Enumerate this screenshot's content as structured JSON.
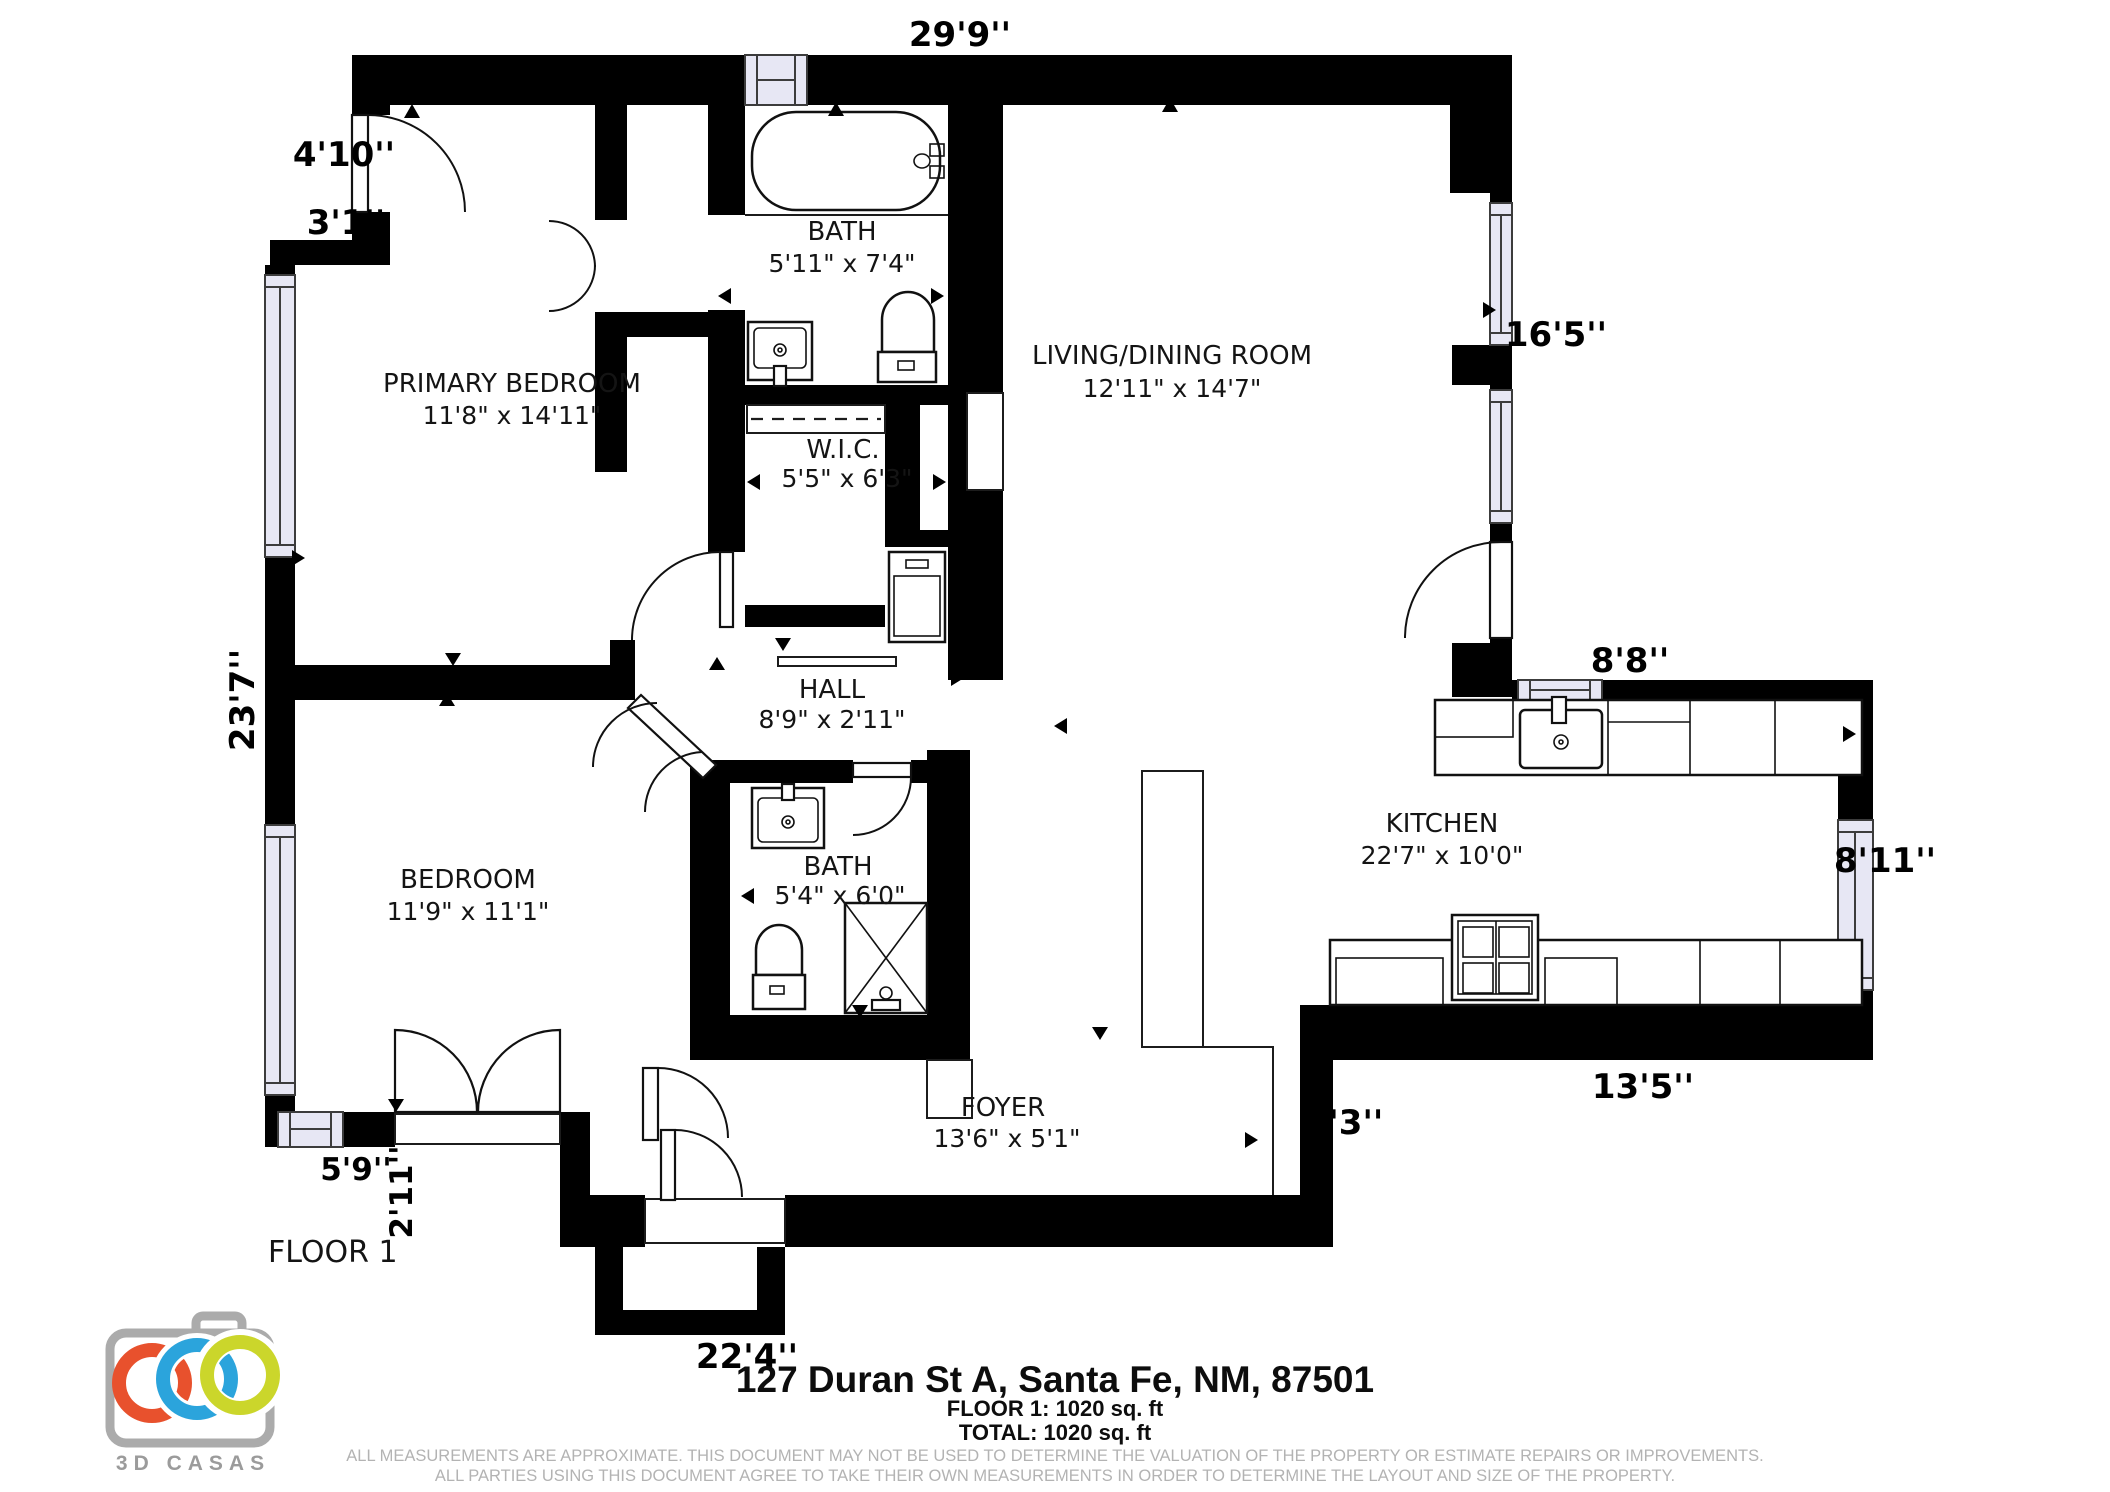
{
  "colors": {
    "window_fill": "#e7e7f4",
    "wall": "#000000",
    "disclaimer_gray": "#b3b3b3"
  },
  "plan": {
    "floor_label": "FLOOR 1",
    "rooms": [
      {
        "name": "PRIMARY BEDROOM",
        "dims": "11'8\" x 14'11\""
      },
      {
        "name": "BATH",
        "dims": "5'11\" x 7'4\""
      },
      {
        "name": "LIVING/DINING ROOM",
        "dims": "12'11\" x 14'7\""
      },
      {
        "name": "W.I.C.",
        "dims": "5'5\" x 6'3\""
      },
      {
        "name": "HALL",
        "dims": "8'9\" x 2'11\""
      },
      {
        "name": "BEDROOM",
        "dims": "11'9\" x 11'1\""
      },
      {
        "name": "BATH",
        "dims": "5'4\" x 6'0\""
      },
      {
        "name": "KITCHEN",
        "dims": "22'7\" x 10'0\""
      },
      {
        "name": "FOYER",
        "dims": "13'6\" x 5'1\""
      }
    ],
    "dimensions": {
      "top": "29'9''",
      "left_door": "4'10''",
      "left_step": "3'1''",
      "left_side": "23'7''",
      "living_right": "16'5''",
      "kitchen_top": "8'8''",
      "kitchen_right": "8'11''",
      "kitchen_bottom": "13'5''",
      "foyer_right": "6'3''",
      "bottom": "22'4''",
      "bedroom_bottom": "5'9''",
      "closet_side": "2'11''"
    }
  },
  "footer": {
    "address": "127 Duran St A, Santa Fe, NM, 87501",
    "floor_line": "FLOOR 1: 1020 sq. ft",
    "total_line": "TOTAL: 1020 sq. ft",
    "disclaimer_line1": "ALL MEASUREMENTS ARE APPROXIMATE. THIS DOCUMENT MAY NOT BE USED TO DETERMINE THE VALUATION OF THE PROPERTY OR ESTIMATE REPAIRS OR IMPROVEMENTS.",
    "disclaimer_line2": "ALL PARTIES USING THIS DOCUMENT AGREE TO TAKE THEIR OWN MEASUREMENTS IN ORDER TO DETERMINE THE LAYOUT AND SIZE OF THE PROPERTY."
  },
  "logo": {
    "brand": "3D CASAS",
    "camera_color": "#ababab",
    "ring_colors": {
      "left": "#e8512d",
      "middle": "#2ba4dc",
      "right": "#cbd62b"
    }
  }
}
